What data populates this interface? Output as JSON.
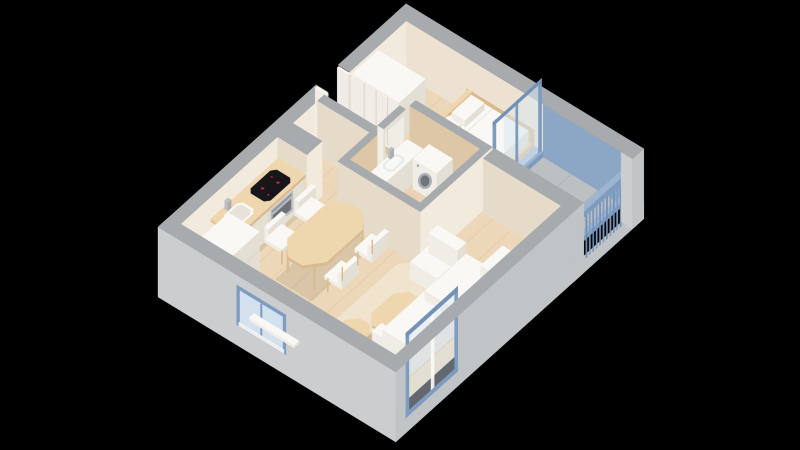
{
  "scene": {
    "type": "isometric-3d-floor-plan-render",
    "background": "#000000",
    "canvas": {
      "width": 800,
      "height": 450
    }
  },
  "palette": {
    "background": "#000000",
    "wall_top": "#a8abae",
    "wall_ext_light": "#cbcdcf",
    "wall_ext_mid": "#c1c4c6",
    "wall_int_cream": "#f2eadd",
    "wall_int_cream2": "#ede2d1",
    "wall_int_shade": "#e6dbc9",
    "floor_wood": "#ecd7b8",
    "floor_plank_line": "#ddc09c",
    "bath_floor": "#e9d3b4",
    "bath_seam": "#d8c09e",
    "bath_wall_wood": "#ddc7a7",
    "rug": "#efe4cf",
    "wood": "#eed6ae",
    "wood_mid": "#e3c59c",
    "wood_dark": "#d9b98e",
    "white_top": "#faf8f4",
    "white_left": "#f0ede6",
    "white_right": "#e3dfd5",
    "seam": "#d9d4c9",
    "steel": "#b9bdc1",
    "oven_glass": "#6e7276",
    "cooktop": "#17171b",
    "burner_red": "#c9252b",
    "blue_wall": "#8ca7c6",
    "blue_wall_shade": "#7b96b7",
    "blue_frame": "#7e9cc0",
    "blue_frame_dark": "#7391b6",
    "blue_sill": "#9db4d1",
    "glass": "#d9e7f1",
    "concrete": "#bdc0c2",
    "concrete_seam": "#abaeb0",
    "basin_shade": "#e6ebeb",
    "washer_ring": "#aab0b6",
    "washer_door": "#6f757b",
    "shadow": "rgba(0,0,0,0.08)"
  },
  "rooms": [
    {
      "id": "kitchen",
      "label": "Kitchen",
      "items": [
        "kitchen-counter",
        "kitchen-sink",
        "cooktop",
        "oven",
        "fridge"
      ]
    },
    {
      "id": "dining-area",
      "label": "Dining area",
      "items": [
        "dining-table",
        "dining-chair",
        "side-cabinet"
      ]
    },
    {
      "id": "living-area",
      "label": "Living area",
      "items": [
        "sofa",
        "coffee-table",
        "area-rug",
        "sofa-side-table",
        "living-window"
      ]
    },
    {
      "id": "hallway",
      "label": "Hallway",
      "items": [
        "entrance-doorway"
      ]
    },
    {
      "id": "bathroom",
      "label": "Bathroom",
      "items": [
        "vanity-sink",
        "washing-machine",
        "toilet",
        "bidet",
        "bathroom-door"
      ]
    },
    {
      "id": "bedroom",
      "label": "Bedroom",
      "items": [
        "wardrobe",
        "bedside-table",
        "double-bed",
        "pillow",
        "balcony-doors"
      ]
    },
    {
      "id": "balcony",
      "label": "Balcony",
      "items": [
        "balcony-railing",
        "concrete-floor",
        "blue-wall"
      ]
    }
  ]
}
